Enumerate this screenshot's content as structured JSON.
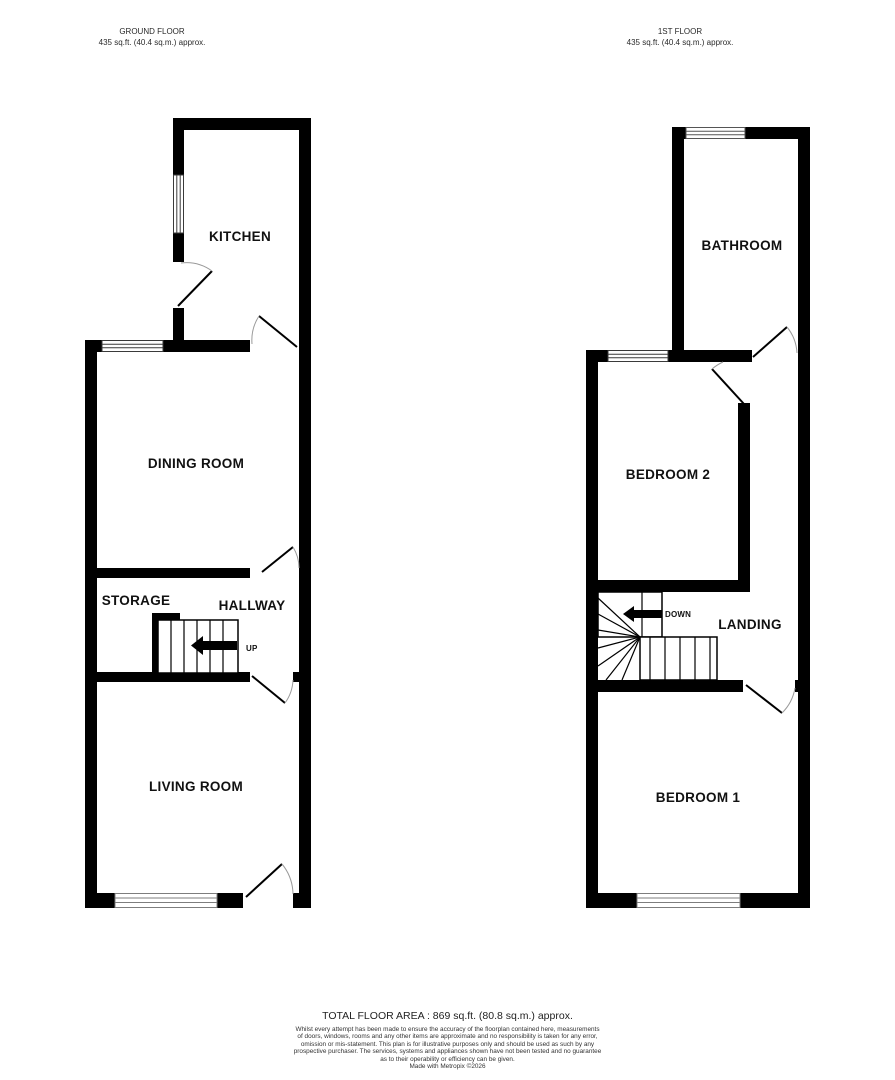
{
  "floors": {
    "ground": {
      "title": "GROUND FLOOR",
      "area": "435 sq.ft. (40.4 sq.m.) approx.",
      "rooms": {
        "kitchen": "KITCHEN",
        "dining": "DINING ROOM",
        "storage": "STORAGE",
        "hallway": "HALLWAY",
        "living": "LIVING ROOM"
      },
      "stair_label": "UP"
    },
    "first": {
      "title": "1ST FLOOR",
      "area": "435 sq.ft. (40.4 sq.m.) approx.",
      "rooms": {
        "bathroom": "BATHROOM",
        "bedroom2": "BEDROOM 2",
        "landing": "LANDING",
        "bedroom1": "BEDROOM 1"
      },
      "stair_label": "DOWN"
    }
  },
  "footer": {
    "total": "TOTAL FLOOR AREA : 869 sq.ft. (80.8 sq.m.) approx.",
    "disclaimer_lines": [
      "Whilst every attempt has been made to ensure the accuracy of the floorplan contained here, measurements",
      "of doors, windows, rooms and any other items are approximate and no responsibility is taken for any error,",
      "omission or mis-statement. This plan is for illustrative purposes only and should be used as such by any",
      "prospective purchaser. The services, systems and appliances shown have not been tested and no guarantee",
      "as to their operability or efficiency can be given."
    ],
    "madewith": "Made with Metropix ©2026"
  },
  "colors": {
    "wall": "#000000",
    "door_arc": "#9a9a9a",
    "window_dark": "#3a3a3a",
    "window_light": "#7d7d7d"
  }
}
